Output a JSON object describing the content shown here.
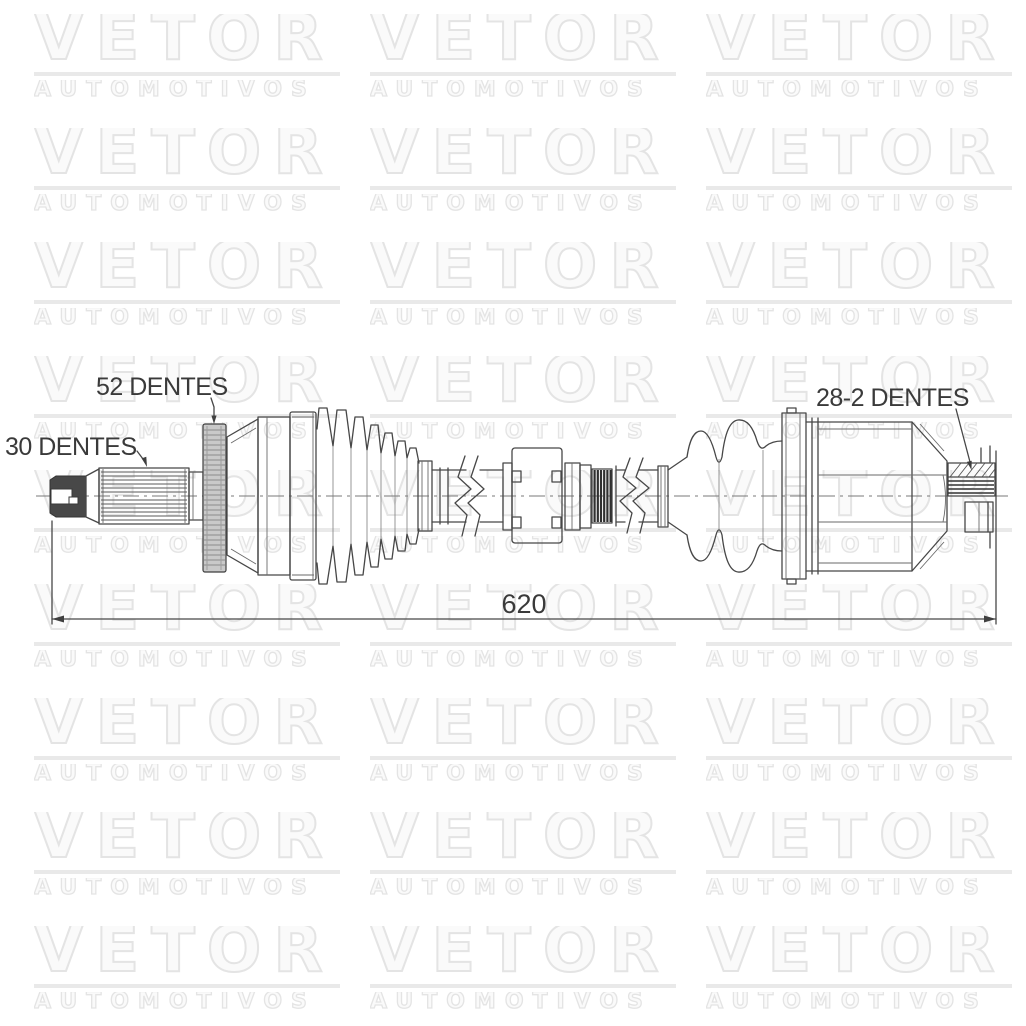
{
  "watermark": {
    "line1": "VETOR",
    "line2": "AUTOMOTIVOS",
    "rows": 9,
    "cols": 3,
    "outline_color": "#e4e4e4"
  },
  "drawing": {
    "labels": {
      "outer_spline": "30 DENTES",
      "abs_ring": "52 DENTES",
      "inner_spline": "28-2 DENTES"
    },
    "dimension": {
      "overall_length": "620"
    },
    "colors": {
      "line": "#474747",
      "dark_fill": "#484848",
      "abs_ring_fill": "#c9c9c9"
    }
  }
}
